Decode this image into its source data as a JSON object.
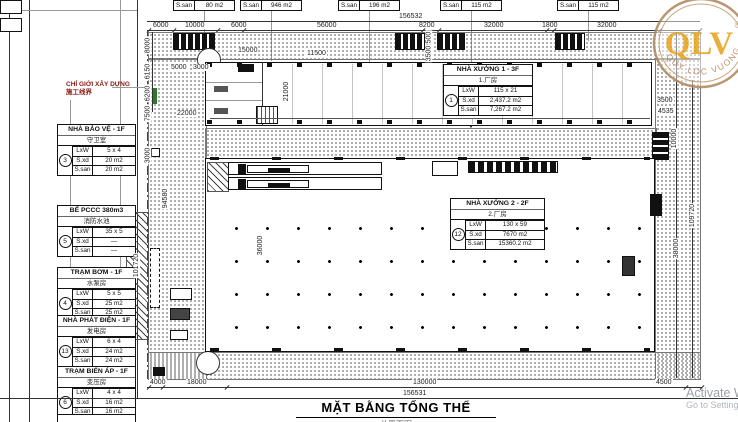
{
  "brand": {
    "logo": "QLV",
    "reg": "®",
    "tagline": "QUY LOC VUONG"
  },
  "activation": {
    "line1": "Activate W",
    "line2": "Go to Settings"
  },
  "title_block": {
    "title": "MẶT BẰNG TỔNG THỂ",
    "subtitle_cn": "总平面图"
  },
  "boundary_note": {
    "vi": "CHỈ GIỚI XÂY DỰNG",
    "cn": "施工线界"
  },
  "row_labels": {
    "lxw": "LxW",
    "sxd": "S.xd",
    "ssan": "S.san"
  },
  "legend_boxes": [
    {
      "title": "NHÀ BẢO VỆ - 1F",
      "cn": "守卫室",
      "num": "3",
      "lxw": "5 x 4",
      "sxd": "20 m2",
      "ssan": "20 m2"
    },
    {
      "title": "BỂ PCCC 380m3",
      "cn": "消防水池",
      "num": "5",
      "lxw": "35 x 5",
      "sxd": "—",
      "ssan": "—"
    },
    {
      "title": "TRẠM BƠM - 1F",
      "cn": "水泵房",
      "num": "4",
      "lxw": "5 x 5",
      "sxd": "25 m2",
      "ssan": "25 m2"
    },
    {
      "title": "NHÀ PHÁT ĐIỆN - 1F",
      "cn": "发电房",
      "num": "13",
      "lxw": "6 x 4",
      "sxd": "24 m2",
      "ssan": "24 m2"
    },
    {
      "title": "TRẠM BIẾN ÁP - 1F",
      "cn": "变压房",
      "num": "6",
      "lxw": "4 x 4",
      "sxd": "16 m2",
      "ssan": "16 m2"
    }
  ],
  "factory_boxes": [
    {
      "title": "NHÀ XƯỞNG 1 - 3F",
      "cn": "1.厂房",
      "num": "1",
      "lxw": "115 x 21",
      "sxd": "2,437.2 m2",
      "ssan": "7,267.2 m2"
    },
    {
      "title": "NHÀ XƯỞNG 2 - 2F",
      "cn": "2.厂房",
      "num": "12",
      "lxw": "130 x 59",
      "sxd": "7670 m2",
      "ssan": "15360.2 m2"
    }
  ],
  "area_tags": [
    {
      "label": "S.san",
      "value": "80 m2"
    },
    {
      "label": "S.san",
      "value": "946 m2"
    },
    {
      "label": "S.san",
      "value": "196 m2"
    },
    {
      "label": "S.san",
      "value": "115 m2"
    },
    {
      "label": "S.san",
      "value": "115 m2"
    }
  ],
  "dims": {
    "top_overall": "156532",
    "top": [
      "6000",
      "10000",
      "6000",
      "56000",
      "8200",
      "32000",
      "1800",
      "32000"
    ],
    "bottom": [
      "4000",
      "18000",
      "130000",
      "4500"
    ],
    "bottom_overall": "156531",
    "left": [
      "8000",
      "6150",
      "6200",
      "7500",
      "3000",
      "94580",
      "101720"
    ],
    "right": [
      "3500",
      "4535",
      "10000",
      "109720",
      "38000"
    ],
    "inner": [
      "5000",
      "3000",
      "15000",
      "2500",
      "3500",
      "22000",
      "21000",
      "115000",
      "36000",
      "11500"
    ]
  }
}
